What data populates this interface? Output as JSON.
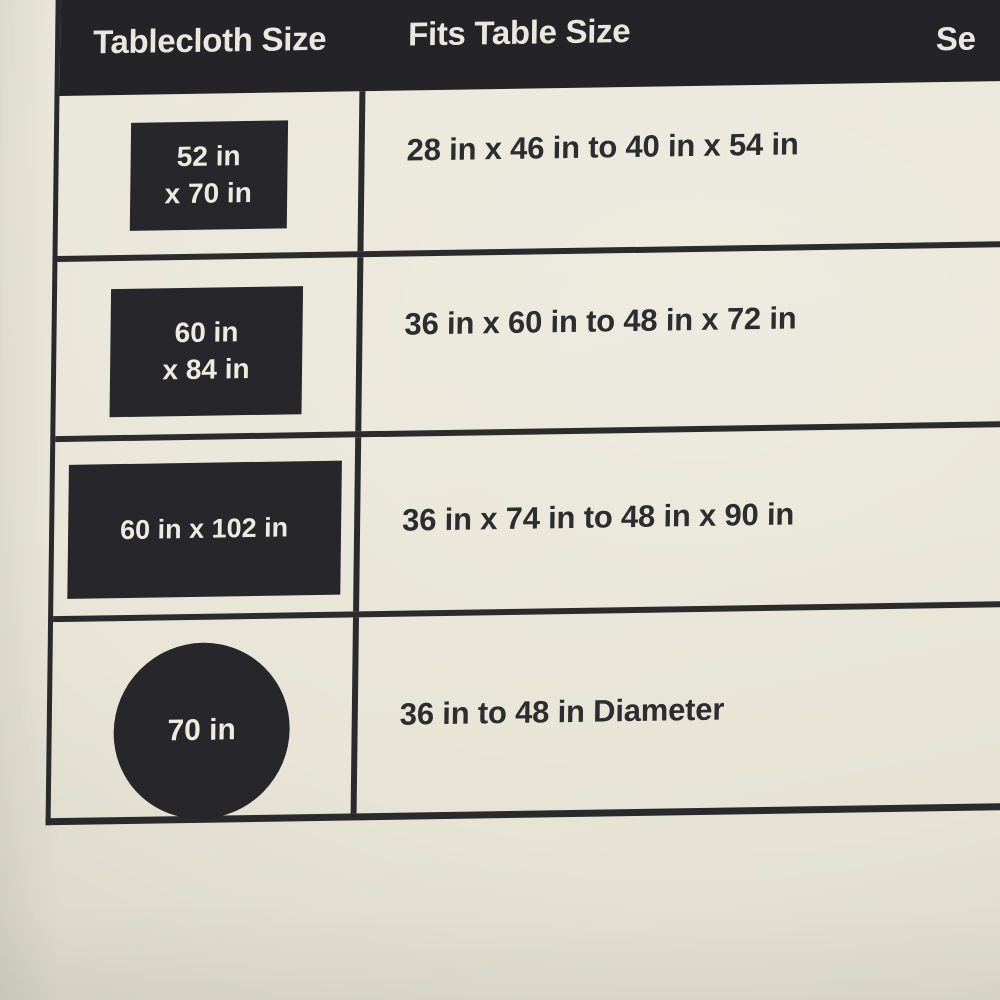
{
  "header": {
    "col1": "Tablecloth Size",
    "col2": "Fits Table Size",
    "col3_partial": "Se"
  },
  "table": {
    "rows": [
      {
        "size_line1": "52 in",
        "size_line2": "x 70 in",
        "swatch_shape": "rectangle",
        "fits": "28 in x 46 in to 40 in x 54 in",
        "col3_partial": "4"
      },
      {
        "size_line1": "60 in",
        "size_line2": "x 84 in",
        "swatch_shape": "rectangle",
        "fits": "36 in x 60 in to 48 in x 72 in",
        "col3_partial": "6"
      },
      {
        "size_line1": "60 in x 102 in",
        "size_line2": "",
        "swatch_shape": "wide-rectangle",
        "fits": "36 in x 74 in to 48 in x 90 in",
        "col3_partial": ""
      },
      {
        "size_line1": "70 in",
        "size_line2": "",
        "swatch_shape": "circle",
        "fits": "36 in to 48 in Diameter",
        "col3_partial": ""
      }
    ]
  },
  "colors": {
    "card_cream": "#e9e6d8",
    "ink_black": "#232328",
    "line_black": "#2b2b2e",
    "text_dark": "#2d2d30",
    "text_light": "#ecebe0"
  },
  "chart_data": {
    "type": "table",
    "columns": [
      "Tablecloth Size",
      "Fits Table Size",
      "Se"
    ],
    "swatch_shapes": [
      "rectangle",
      "rectangle",
      "wide-rectangle",
      "circle"
    ],
    "rows": [
      [
        "52 in x 70 in",
        "28 in x 46 in to 40 in x 54 in",
        "4"
      ],
      [
        "60 in x 84 in",
        "36 in x 60 in to 48 in x 72 in",
        "6"
      ],
      [
        "60 in x 102 in",
        "36 in x 74 in to 48 in x 90 in",
        ""
      ],
      [
        "70 in",
        "36 in to 48 in Diameter",
        ""
      ]
    ]
  }
}
